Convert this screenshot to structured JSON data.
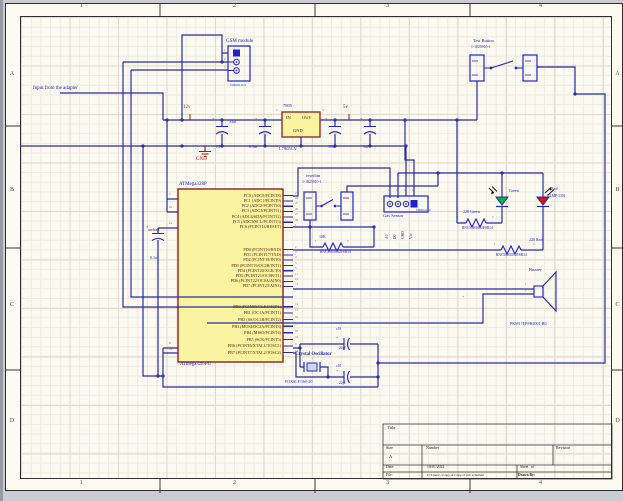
{
  "frame": {
    "cols": [
      "1",
      "2",
      "3",
      "4"
    ],
    "rows": [
      "A",
      "B",
      "C",
      "D"
    ]
  },
  "notes": {
    "input_adapter": "Input from the adapter"
  },
  "power": {
    "v12": "12v",
    "v5": "5v",
    "gnd": "GND",
    "regulator": {
      "name": "7805",
      "part": "L7805CV",
      "pin_in": "IN",
      "pin_out": "OUT",
      "pin_gnd": "GND",
      "num_in": "1",
      "num_out": "3"
    },
    "cap1_name": "C1",
    "cap1_val": "33uf",
    "cap2_val": "0.1uf",
    "cap3_val": "10uf",
    "cap4_val": "1uf",
    "plus_marks": [
      "+",
      "+",
      "+",
      "+",
      "+",
      "+",
      "+",
      "+"
    ]
  },
  "gsm": {
    "label": "GSM module",
    "part": "61900311121",
    "pin_nums": [
      "1",
      "2",
      "3"
    ]
  },
  "test_button": {
    "label": "Test Button",
    "part": "1-1825910-1"
  },
  "reset_button": {
    "label": "resetbtn",
    "part": "1-1825910-1"
  },
  "r_reset": {
    "value": "10K",
    "part": "RNC55H1002FSB14",
    "pin1": "1",
    "pin2": "2"
  },
  "gas_sensor": {
    "label": "Gas Sensor",
    "part": "61900411121",
    "pin_nums": [
      "1",
      "2",
      "3",
      "4"
    ],
    "pin_labels": [
      "A0",
      "D0",
      "GND",
      "Vcc"
    ]
  },
  "led_green": {
    "label": "Green"
  },
  "led_red": {
    "label": "Red",
    "part": "HLMP-3301"
  },
  "r_green": {
    "value": "220 Green",
    "part": "RNC55H1002FSB14",
    "pin1": "1",
    "pin2": "2"
  },
  "r_red": {
    "value": "220 Red",
    "part": "RNC55H1002FSB14",
    "pin1": "1",
    "pin2": "2"
  },
  "buzzer": {
    "label": "Buzzer",
    "part": "PKM17EPPH4001-B0",
    "pin1": "1",
    "pin2": "2"
  },
  "crystal": {
    "label": "Crystal Oscillator",
    "part": "FOXSLF/160-20",
    "cap_a_name": "c19",
    "cap_a_val": "22pf",
    "cap_b_name": "c10",
    "cap_b_val": "22pf"
  },
  "aref": {
    "name": "arefcap",
    "value": "0.1uf"
  },
  "mcu": {
    "title": "ATMega328P",
    "part": "ATmega328-PU",
    "left_names": [
      "VCC",
      "AVCC",
      "AREF",
      "GND",
      "GND"
    ],
    "left_nums": [
      "7",
      "20",
      "21",
      "8",
      "22"
    ],
    "pc_names": [
      "PC0 (ADC0/PCINT8)",
      "PC1 (ADC1/PCINT9)",
      "PC2 (ADC2/PCINT10)",
      "PC3 (ADC3/PCINT11)",
      "PC4 (ADC4/SDA/PCINT12)",
      "PC5 (ADC5/SCL/PCINT13)",
      "PC6 (PCINT14/RESET)"
    ],
    "pc_nums": [
      "23",
      "24",
      "25",
      "26",
      "27",
      "28",
      "1"
    ],
    "pd_names": [
      "PD0 (PCINT16/RXD)",
      "PD1 (PCINT17/TXD)",
      "PD2 (PCINT18/INT0)",
      "PD3 (PCINT19/OC2B/INT1)",
      "PD4 (PCINT20/XCK/T0)",
      "PD5 (PCINT21/OC0B/T1)",
      "PD6 (PCINT22/OC0A/AIN0)",
      "PD7 (PCINT23/AIN1)"
    ],
    "pd_nums": [
      "2",
      "3",
      "4",
      "5",
      "6",
      "11",
      "12",
      "13"
    ],
    "pb_names": [
      "PB0 (PCINT0/CLKO/ICP1)",
      "PB1 (OC1A/PCINT1)",
      "PB2 (SS/OC1B/PCINT2)",
      "PB3 (MOSI/OC2A/PCINT3)",
      "PB4 (MISO/PCINT4)",
      "PB5 (SCK/PCINT5)",
      "PB6 (PCINT6/XTAL1/TOSC1)",
      "PB7 (PCINT7/XTAL2/TOSC2)"
    ],
    "pb_nums": [
      "14",
      "15",
      "16",
      "17",
      "18",
      "19",
      "9",
      "10"
    ]
  },
  "title_block": {
    "title_label": "Title",
    "size_label": "Size",
    "size": "A",
    "number_label": "Number",
    "revision_label": "Revision",
    "date_label": "Date:",
    "date": "10/07/2022",
    "sheet": "Sheet   of",
    "file_label": "File:",
    "file": "C:\\Users\\..\\Copy of Copy of pcb schemati",
    "drawn": "Drawn By:"
  }
}
